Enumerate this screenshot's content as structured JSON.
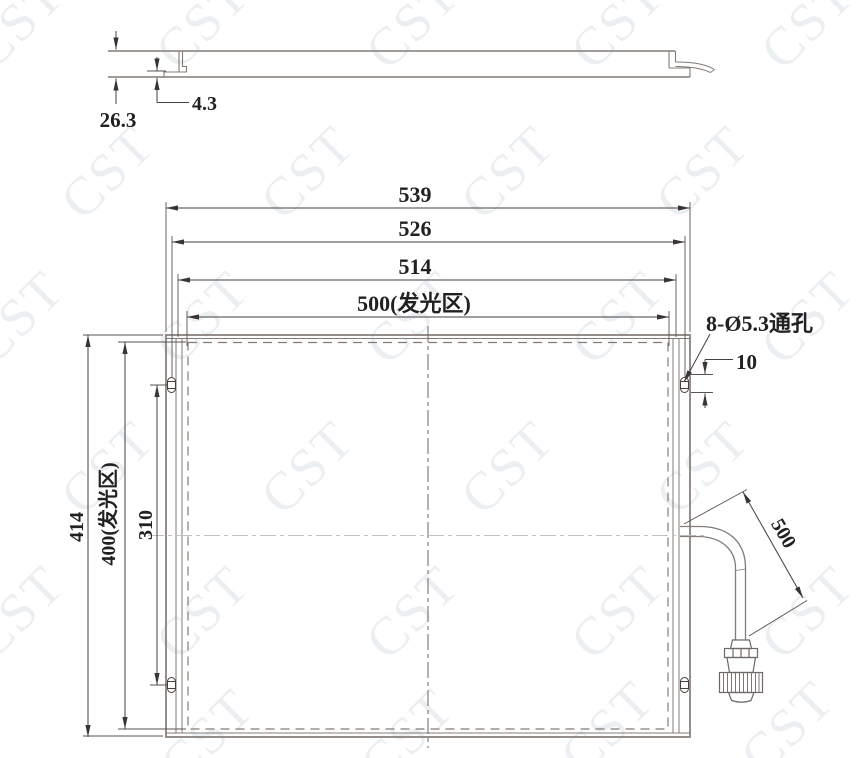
{
  "watermark": {
    "text": "CST"
  },
  "side_view": {
    "overall_thickness": "26.3",
    "bracket_step": "4.3"
  },
  "front_view": {
    "dim_overall_width": "539",
    "dim_hole_spacing_width": "526",
    "dim_frame_width": "514",
    "dim_emitting_width": "500(发光区)",
    "dim_overall_height": "414",
    "dim_emitting_height": "400(发光区)",
    "dim_hole_spacing_height": "310",
    "hole_note": "8-Ø5.3通孔",
    "dim_hole_offset": "10"
  },
  "cable": {
    "dim_length": "500"
  },
  "colors": {
    "line": "#837b76",
    "dimension": "#45403e",
    "text": "#232020",
    "watermark": "#b7c3cf"
  }
}
